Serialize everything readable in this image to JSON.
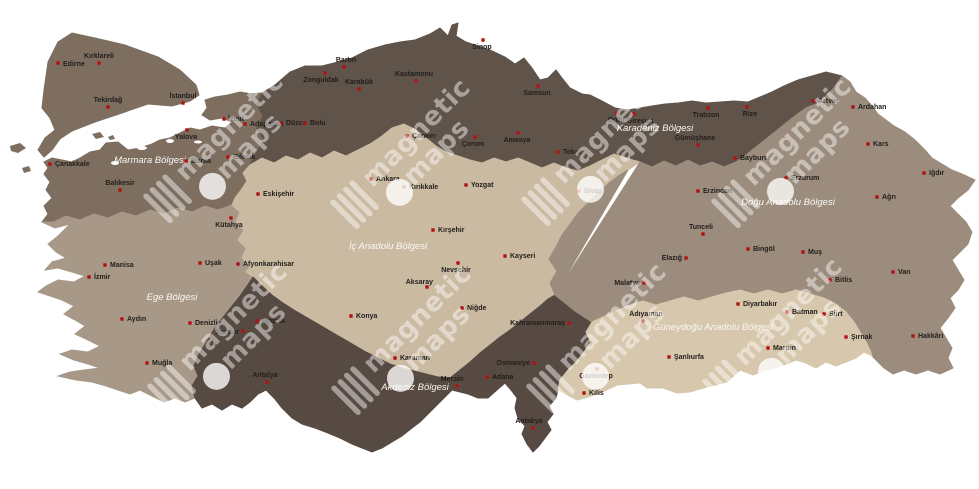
{
  "map": {
    "background_color": "#ffffff",
    "city_dot_color": "#b11313",
    "city_label_color": "#211e1b",
    "region_label_color": "#faf8f4",
    "watermark": {
      "line1": "magnetic",
      "line2": "maps",
      "color": "#ffffff",
      "text_opacity": 0.45,
      "circle_opacity": 0.78,
      "positions": [
        [
          204,
          175
        ],
        [
          391,
          181
        ],
        [
          582,
          178
        ],
        [
          772,
          180
        ],
        [
          208,
          365
        ],
        [
          392,
          367
        ],
        [
          587,
          365
        ],
        [
          763,
          360
        ]
      ]
    },
    "regions": [
      {
        "id": "marmara",
        "name": "Marmara Bölgesi",
        "color": "#7d6e60",
        "label_x": 150,
        "label_y": 163
      },
      {
        "id": "ege",
        "name": "Ege Bölgesi",
        "color": "#a89887",
        "label_x": 172,
        "label_y": 300
      },
      {
        "id": "karadeniz",
        "name": "Karadeniz Bölgesi",
        "color": "#60544a",
        "label_x": 655,
        "label_y": 131
      },
      {
        "id": "ic_anadolu",
        "name": "İç Anadolu Bölgesi",
        "color": "#cbbaa2",
        "label_x": 388,
        "label_y": 249
      },
      {
        "id": "akdeniz",
        "name": "Akdeniz Bölgesi",
        "color": "#574a42",
        "label_x": 415,
        "label_y": 390
      },
      {
        "id": "dogu_anadolu",
        "name": "Doğu Anadolu Bölgesi",
        "color": "#9c8c7d",
        "label_x": 788,
        "label_y": 205
      },
      {
        "id": "guneydogu",
        "name": "Güneydoğu Anadolu Bölgesi",
        "color": "#d7c7ac",
        "label_x": 713,
        "label_y": 330
      }
    ],
    "cities": [
      {
        "name": "Edirne",
        "region": "marmara",
        "x": 58,
        "y": 63,
        "lx": 63,
        "ly": 66,
        "anchor": "start"
      },
      {
        "name": "Kırklareli",
        "region": "marmara",
        "x": 99,
        "y": 63,
        "lx": 99,
        "ly": 58,
        "anchor": "middle"
      },
      {
        "name": "Tekirdağ",
        "region": "marmara",
        "x": 108,
        "y": 107,
        "lx": 108,
        "ly": 102,
        "anchor": "middle"
      },
      {
        "name": "İstanbul",
        "region": "marmara",
        "x": 183,
        "y": 103,
        "lx": 183,
        "ly": 98,
        "anchor": "middle"
      },
      {
        "name": "Yalova",
        "region": "marmara",
        "x": 187,
        "y": 130,
        "lx": 186,
        "ly": 139,
        "anchor": "middle"
      },
      {
        "name": "İzmit",
        "region": "marmara",
        "x": 224,
        "y": 119,
        "lx": 228,
        "ly": 121,
        "anchor": "start"
      },
      {
        "name": "Adapazarı",
        "region": "marmara",
        "x": 245,
        "y": 124,
        "lx": 250,
        "ly": 126,
        "anchor": "start"
      },
      {
        "name": "Bilecik",
        "region": "marmara",
        "x": 228,
        "y": 157,
        "lx": 233,
        "ly": 159,
        "anchor": "start"
      },
      {
        "name": "Bursa",
        "region": "marmara",
        "x": 186,
        "y": 161,
        "lx": 191,
        "ly": 163,
        "anchor": "start"
      },
      {
        "name": "Balıkesir",
        "region": "marmara",
        "x": 120,
        "y": 190,
        "lx": 120,
        "ly": 185,
        "anchor": "middle"
      },
      {
        "name": "Çanakkale",
        "region": "marmara",
        "x": 50,
        "y": 164,
        "lx": 55,
        "ly": 166,
        "anchor": "start"
      },
      {
        "name": "Zonguldak",
        "region": "karadeniz",
        "x": 325,
        "y": 73,
        "lx": 321,
        "ly": 82,
        "anchor": "middle"
      },
      {
        "name": "Bartın",
        "region": "karadeniz",
        "x": 344,
        "y": 67,
        "lx": 346,
        "ly": 62,
        "anchor": "middle"
      },
      {
        "name": "Karabük",
        "region": "karadeniz",
        "x": 359,
        "y": 89,
        "lx": 359,
        "ly": 84,
        "anchor": "middle"
      },
      {
        "name": "Kastamonu",
        "region": "karadeniz",
        "x": 416,
        "y": 81,
        "lx": 414,
        "ly": 76,
        "anchor": "middle"
      },
      {
        "name": "Sinop",
        "region": "karadeniz",
        "x": 483,
        "y": 40,
        "lx": 482,
        "ly": 49,
        "anchor": "middle"
      },
      {
        "name": "Samsun",
        "region": "karadeniz",
        "x": 538,
        "y": 86,
        "lx": 537,
        "ly": 95,
        "anchor": "middle"
      },
      {
        "name": "Amasya",
        "region": "karadeniz",
        "x": 518,
        "y": 133,
        "lx": 517,
        "ly": 142,
        "anchor": "middle"
      },
      {
        "name": "Çorum",
        "region": "karadeniz",
        "x": 475,
        "y": 137,
        "lx": 473,
        "ly": 146,
        "anchor": "middle"
      },
      {
        "name": "Tokat",
        "region": "karadeniz",
        "x": 558,
        "y": 152,
        "lx": 563,
        "ly": 154,
        "anchor": "start"
      },
      {
        "name": "Ordu",
        "region": "karadeniz",
        "x": 617,
        "y": 113,
        "lx": 616,
        "ly": 122,
        "anchor": "middle"
      },
      {
        "name": "Giresun",
        "region": "karadeniz",
        "x": 634,
        "y": 114,
        "lx": 640,
        "ly": 123,
        "anchor": "middle"
      },
      {
        "name": "Gümüşhane",
        "region": "karadeniz",
        "x": 698,
        "y": 145,
        "lx": 695,
        "ly": 140,
        "anchor": "middle"
      },
      {
        "name": "Trabzon",
        "region": "karadeniz",
        "x": 708,
        "y": 108,
        "lx": 706,
        "ly": 117,
        "anchor": "middle"
      },
      {
        "name": "Rize",
        "region": "karadeniz",
        "x": 747,
        "y": 107,
        "lx": 750,
        "ly": 116,
        "anchor": "middle"
      },
      {
        "name": "Artvin",
        "region": "karadeniz",
        "x": 813,
        "y": 101,
        "lx": 818,
        "ly": 103,
        "anchor": "start"
      },
      {
        "name": "Bayburt",
        "region": "karadeniz",
        "x": 735,
        "y": 158,
        "lx": 740,
        "ly": 160,
        "anchor": "start"
      },
      {
        "name": "Düzce",
        "region": "karadeniz",
        "x": 281,
        "y": 123,
        "lx": 286,
        "ly": 125,
        "anchor": "start"
      },
      {
        "name": "Bolu",
        "region": "karadeniz",
        "x": 305,
        "y": 123,
        "lx": 310,
        "ly": 125,
        "anchor": "start"
      },
      {
        "name": "Eskişehir",
        "region": "ic_anadolu",
        "x": 258,
        "y": 194,
        "lx": 263,
        "ly": 196,
        "anchor": "start"
      },
      {
        "name": "Ankara",
        "region": "ic_anadolu",
        "x": 371,
        "y": 179,
        "lx": 376,
        "ly": 181,
        "anchor": "start"
      },
      {
        "name": "Kırıkkale",
        "region": "ic_anadolu",
        "x": 404,
        "y": 187,
        "lx": 409,
        "ly": 189,
        "anchor": "start"
      },
      {
        "name": "Çankırı",
        "region": "ic_anadolu",
        "x": 407,
        "y": 136,
        "lx": 412,
        "ly": 138,
        "anchor": "start"
      },
      {
        "name": "Yozgat",
        "region": "ic_anadolu",
        "x": 466,
        "y": 185,
        "lx": 471,
        "ly": 187,
        "anchor": "start"
      },
      {
        "name": "Sivas",
        "region": "ic_anadolu",
        "x": 579,
        "y": 191,
        "lx": 584,
        "ly": 193,
        "anchor": "start"
      },
      {
        "name": "Kırşehir",
        "region": "ic_anadolu",
        "x": 433,
        "y": 230,
        "lx": 438,
        "ly": 232,
        "anchor": "start"
      },
      {
        "name": "Nevşehir",
        "region": "ic_anadolu",
        "x": 458,
        "y": 263,
        "lx": 456,
        "ly": 272,
        "anchor": "middle"
      },
      {
        "name": "Kayseri",
        "region": "ic_anadolu",
        "x": 505,
        "y": 256,
        "lx": 510,
        "ly": 258,
        "anchor": "start"
      },
      {
        "name": "Aksaray",
        "region": "ic_anadolu",
        "x": 427,
        "y": 287,
        "lx": 433,
        "ly": 284,
        "anchor": "end"
      },
      {
        "name": "Niğde",
        "region": "ic_anadolu",
        "x": 462,
        "y": 308,
        "lx": 467,
        "ly": 310,
        "anchor": "start"
      },
      {
        "name": "Konya",
        "region": "ic_anadolu",
        "x": 351,
        "y": 316,
        "lx": 356,
        "ly": 318,
        "anchor": "start"
      },
      {
        "name": "Karaman",
        "region": "ic_anadolu",
        "x": 395,
        "y": 358,
        "lx": 400,
        "ly": 360,
        "anchor": "start"
      },
      {
        "name": "Kütahya",
        "region": "ege",
        "x": 231,
        "y": 218,
        "lx": 229,
        "ly": 227,
        "anchor": "middle"
      },
      {
        "name": "Uşak",
        "region": "ege",
        "x": 200,
        "y": 263,
        "lx": 205,
        "ly": 265,
        "anchor": "start"
      },
      {
        "name": "Afyonkarahisar",
        "region": "ege",
        "x": 238,
        "y": 264,
        "lx": 243,
        "ly": 266,
        "anchor": "start"
      },
      {
        "name": "Manisa",
        "region": "ege",
        "x": 105,
        "y": 265,
        "lx": 110,
        "ly": 267,
        "anchor": "start"
      },
      {
        "name": "İzmir",
        "region": "ege",
        "x": 89,
        "y": 277,
        "lx": 94,
        "ly": 279,
        "anchor": "start"
      },
      {
        "name": "Aydın",
        "region": "ege",
        "x": 122,
        "y": 319,
        "lx": 127,
        "ly": 321,
        "anchor": "start"
      },
      {
        "name": "Denizli",
        "region": "ege",
        "x": 190,
        "y": 323,
        "lx": 195,
        "ly": 325,
        "anchor": "start"
      },
      {
        "name": "Muğla",
        "region": "ege",
        "x": 147,
        "y": 363,
        "lx": 152,
        "ly": 365,
        "anchor": "start"
      },
      {
        "name": "Isparta",
        "region": "akdeniz",
        "x": 257,
        "y": 321,
        "lx": 262,
        "ly": 323,
        "anchor": "start"
      },
      {
        "name": "Burdur",
        "region": "akdeniz",
        "x": 243,
        "y": 331,
        "lx": 239,
        "ly": 334,
        "anchor": "end"
      },
      {
        "name": "Antalya",
        "region": "akdeniz",
        "x": 267,
        "y": 382,
        "lx": 265,
        "ly": 377,
        "anchor": "middle"
      },
      {
        "name": "Mersin",
        "region": "akdeniz",
        "x": 457,
        "y": 386,
        "lx": 452,
        "ly": 381,
        "anchor": "middle"
      },
      {
        "name": "Adana",
        "region": "akdeniz",
        "x": 487,
        "y": 377,
        "lx": 492,
        "ly": 379,
        "anchor": "start"
      },
      {
        "name": "Osmaniye",
        "region": "akdeniz",
        "x": 534,
        "y": 363,
        "lx": 530,
        "ly": 365,
        "anchor": "end"
      },
      {
        "name": "Kahramanmaraş",
        "region": "akdeniz",
        "x": 569,
        "y": 323,
        "lx": 565,
        "ly": 325,
        "anchor": "end"
      },
      {
        "name": "Antakya",
        "region": "akdeniz",
        "x": 533,
        "y": 428,
        "lx": 529,
        "ly": 423,
        "anchor": "middle"
      },
      {
        "name": "Tunceli",
        "region": "dogu_anadolu",
        "x": 703,
        "y": 234,
        "lx": 701,
        "ly": 229,
        "anchor": "middle"
      },
      {
        "name": "Erzincan",
        "region": "dogu_anadolu",
        "x": 698,
        "y": 191,
        "lx": 703,
        "ly": 193,
        "anchor": "start"
      },
      {
        "name": "Erzurum",
        "region": "dogu_anadolu",
        "x": 786,
        "y": 178,
        "lx": 791,
        "ly": 180,
        "anchor": "start"
      },
      {
        "name": "Ardahan",
        "region": "dogu_anadolu",
        "x": 853,
        "y": 107,
        "lx": 858,
        "ly": 109,
        "anchor": "start"
      },
      {
        "name": "Kars",
        "region": "dogu_anadolu",
        "x": 868,
        "y": 144,
        "lx": 873,
        "ly": 146,
        "anchor": "start"
      },
      {
        "name": "Iğdır",
        "region": "dogu_anadolu",
        "x": 924,
        "y": 173,
        "lx": 929,
        "ly": 175,
        "anchor": "start"
      },
      {
        "name": "Ağrı",
        "region": "dogu_anadolu",
        "x": 877,
        "y": 197,
        "lx": 882,
        "ly": 199,
        "anchor": "start"
      },
      {
        "name": "Elazığ",
        "region": "dogu_anadolu",
        "x": 686,
        "y": 258,
        "lx": 682,
        "ly": 260,
        "anchor": "end"
      },
      {
        "name": "Bingöl",
        "region": "dogu_anadolu",
        "x": 748,
        "y": 249,
        "lx": 753,
        "ly": 251,
        "anchor": "start"
      },
      {
        "name": "Muş",
        "region": "dogu_anadolu",
        "x": 803,
        "y": 252,
        "lx": 808,
        "ly": 254,
        "anchor": "start"
      },
      {
        "name": "Bitlis",
        "region": "dogu_anadolu",
        "x": 830,
        "y": 280,
        "lx": 835,
        "ly": 282,
        "anchor": "start"
      },
      {
        "name": "Van",
        "region": "dogu_anadolu",
        "x": 893,
        "y": 272,
        "lx": 898,
        "ly": 274,
        "anchor": "start"
      },
      {
        "name": "Malatya",
        "region": "dogu_anadolu",
        "x": 644,
        "y": 283,
        "lx": 640,
        "ly": 285,
        "anchor": "end"
      },
      {
        "name": "Hakkâri",
        "region": "dogu_anadolu",
        "x": 913,
        "y": 336,
        "lx": 918,
        "ly": 338,
        "anchor": "start"
      },
      {
        "name": "Adıyaman",
        "region": "guneydogu",
        "x": 643,
        "y": 321,
        "lx": 646,
        "ly": 316,
        "anchor": "middle"
      },
      {
        "name": "Gaziantep",
        "region": "guneydogu",
        "x": 597,
        "y": 369,
        "lx": 596,
        "ly": 378,
        "anchor": "middle"
      },
      {
        "name": "Kilis",
        "region": "guneydogu",
        "x": 584,
        "y": 393,
        "lx": 589,
        "ly": 395,
        "anchor": "start"
      },
      {
        "name": "Şanlıurfa",
        "region": "guneydogu",
        "x": 669,
        "y": 357,
        "lx": 674,
        "ly": 359,
        "anchor": "start"
      },
      {
        "name": "Diyarbakır",
        "region": "guneydogu",
        "x": 738,
        "y": 304,
        "lx": 743,
        "ly": 306,
        "anchor": "start"
      },
      {
        "name": "Mardin",
        "region": "guneydogu",
        "x": 768,
        "y": 348,
        "lx": 773,
        "ly": 350,
        "anchor": "start"
      },
      {
        "name": "Batman",
        "region": "guneydogu",
        "x": 787,
        "y": 312,
        "lx": 792,
        "ly": 314,
        "anchor": "start"
      },
      {
        "name": "Siirt",
        "region": "guneydogu",
        "x": 824,
        "y": 314,
        "lx": 829,
        "ly": 316,
        "anchor": "start"
      },
      {
        "name": "Şırnak",
        "region": "guneydogu",
        "x": 846,
        "y": 337,
        "lx": 851,
        "ly": 339,
        "anchor": "start"
      }
    ]
  }
}
